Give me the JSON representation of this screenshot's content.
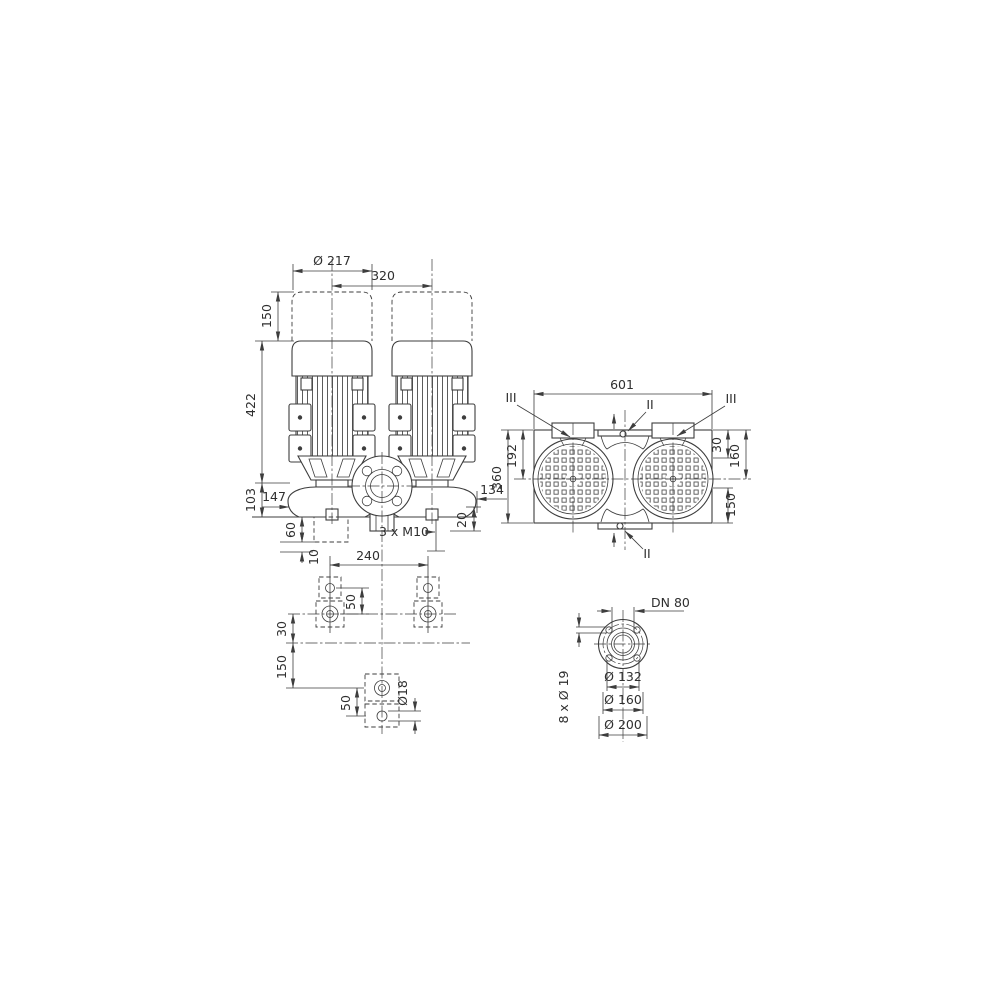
{
  "style": {
    "line_color": "#3d3d3d",
    "text_color": "#2f2f2f",
    "background": "#ffffff"
  },
  "views": {
    "front": {
      "dims": {
        "motor_diameter": "Ø 217",
        "port_spacing": "320",
        "removal_space": "150",
        "motor_height": "422",
        "base_height": "103",
        "foot_offset": "147",
        "foundation_height": "60",
        "grout_thickness": "10",
        "fixing_holes": "3 x M10",
        "foot_thickness": "20",
        "housing_offset": "134",
        "bolt_spacing": "240"
      }
    },
    "plan": {
      "dims": {
        "overall_length": "601",
        "overall_width": "360",
        "edge_to_axis": "192",
        "edge_offset": "30",
        "edge_to_center": "160",
        "center_to_edge": "150"
      },
      "sections": {
        "section_two": "II",
        "section_three": "III"
      }
    },
    "foundation": {
      "dims": {
        "hole_pitch_top": "50",
        "axis_offset": "30",
        "axis_to_bolt": "150",
        "hole_pitch_bottom": "50",
        "hole_diameter": "Ø18"
      }
    },
    "flange": {
      "dims": {
        "nominal": "DN 80",
        "bolt_holes": "8 x Ø 19",
        "raised_face": "Ø 132",
        "bolt_circle": "Ø 160",
        "outer_diameter": "Ø 200"
      }
    }
  }
}
